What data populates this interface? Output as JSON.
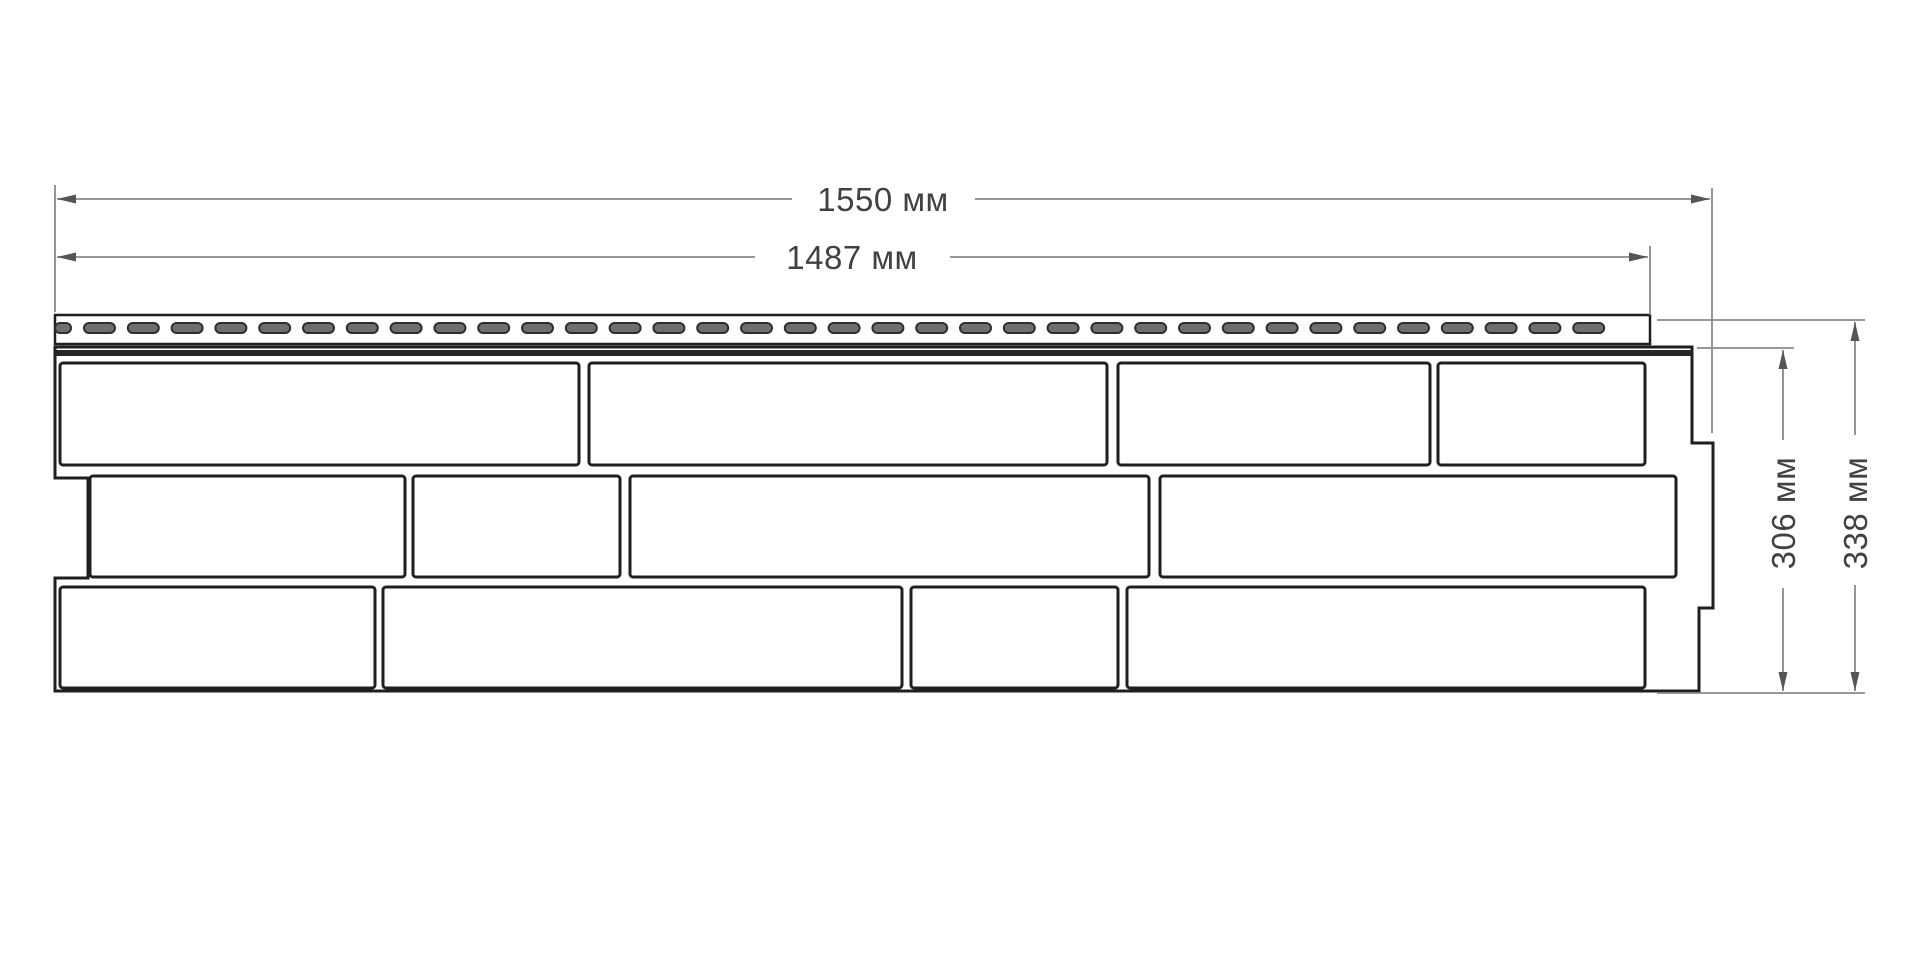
{
  "drawing": {
    "title": "facade-panel-brick-technical-drawing",
    "background": "#ffffff",
    "colors": {
      "outline": "#1f1f1f",
      "brick_stroke": "#1f1f1f",
      "brick_fill": "#ffffff",
      "band_fill": "#262626",
      "slot_fill": "#6e6e6e",
      "slot_stroke": "#2e2e2e",
      "dim_line": "#8a8a8a",
      "dim_arrow": "#555555",
      "dim_text": "#414141"
    },
    "dimensions": [
      {
        "id": "width-total",
        "label": "1550 мм",
        "orientation": "horizontal",
        "line": {
          "y": 199,
          "x1": 57,
          "x2": 1710
        },
        "gap": [
          792,
          975
        ],
        "text": {
          "x": 883,
          "y": 211
        }
      },
      {
        "id": "width-working",
        "label": "1487 мм",
        "orientation": "horizontal",
        "line": {
          "y": 257,
          "x1": 57,
          "x2": 1648
        },
        "gap": [
          755,
          950
        ],
        "text": {
          "x": 852,
          "y": 269
        }
      },
      {
        "id": "height-working",
        "label": "306 мм",
        "orientation": "vertical",
        "line": {
          "x": 1783,
          "y1": 350,
          "y2": 691
        },
        "gap": [
          440,
          588
        ],
        "text": {
          "x": 1795,
          "y": 513
        }
      },
      {
        "id": "height-total",
        "label": "338 мм",
        "orientation": "vertical",
        "line": {
          "x": 1855,
          "y1": 322,
          "y2": 691
        },
        "gap": [
          435,
          585
        ],
        "text": {
          "x": 1867,
          "y": 513
        }
      }
    ],
    "extension_lines": [
      {
        "x1": 55,
        "y1": 185,
        "x2": 55,
        "y2": 312
      },
      {
        "x1": 1712,
        "y1": 188,
        "x2": 1712,
        "y2": 433
      },
      {
        "x1": 1650,
        "y1": 246,
        "x2": 1650,
        "y2": 315
      },
      {
        "x1": 1657,
        "y1": 320,
        "x2": 1865,
        "y2": 320
      },
      {
        "x1": 1697,
        "y1": 348,
        "x2": 1794,
        "y2": 348
      },
      {
        "x1": 1657,
        "y1": 693,
        "x2": 1865,
        "y2": 693
      }
    ],
    "panel": {
      "outline_path": "M 55 347 L 1692 347 L 1692 443 L 1713 443 L 1713 608 L 1699 608 L 1699 691 L 55 691 L 55 578 L 88 578 L 88 478 L 55 478 Z",
      "band": {
        "x": 55,
        "y": 350,
        "w": 1637,
        "h": 6
      },
      "nail_strip": {
        "x": 55,
        "y": 315,
        "w": 1595,
        "h": 29,
        "slot_y": 323,
        "slot_h": 10,
        "slot_r": 5,
        "first_slot": {
          "x": 55,
          "w": 16
        },
        "slots_start": 84,
        "slot_w": 31,
        "slot_pitch": 43.8,
        "slot_count": 35
      },
      "brick_rows": [
        {
          "y": 363,
          "h": 102,
          "bricks": [
            [
              60,
              519
            ],
            [
              589,
              518
            ],
            [
              1118,
              312
            ],
            [
              1438,
              207
            ]
          ]
        },
        {
          "y": 476,
          "h": 101,
          "bricks": [
            [
              90,
              315
            ],
            [
              413,
              207
            ],
            [
              630,
              519
            ],
            [
              1160,
              516
            ]
          ]
        },
        {
          "y": 587,
          "h": 101,
          "bricks": [
            [
              60,
              315
            ],
            [
              383,
              519
            ],
            [
              911,
              207
            ],
            [
              1127,
              518
            ]
          ]
        }
      ]
    }
  }
}
